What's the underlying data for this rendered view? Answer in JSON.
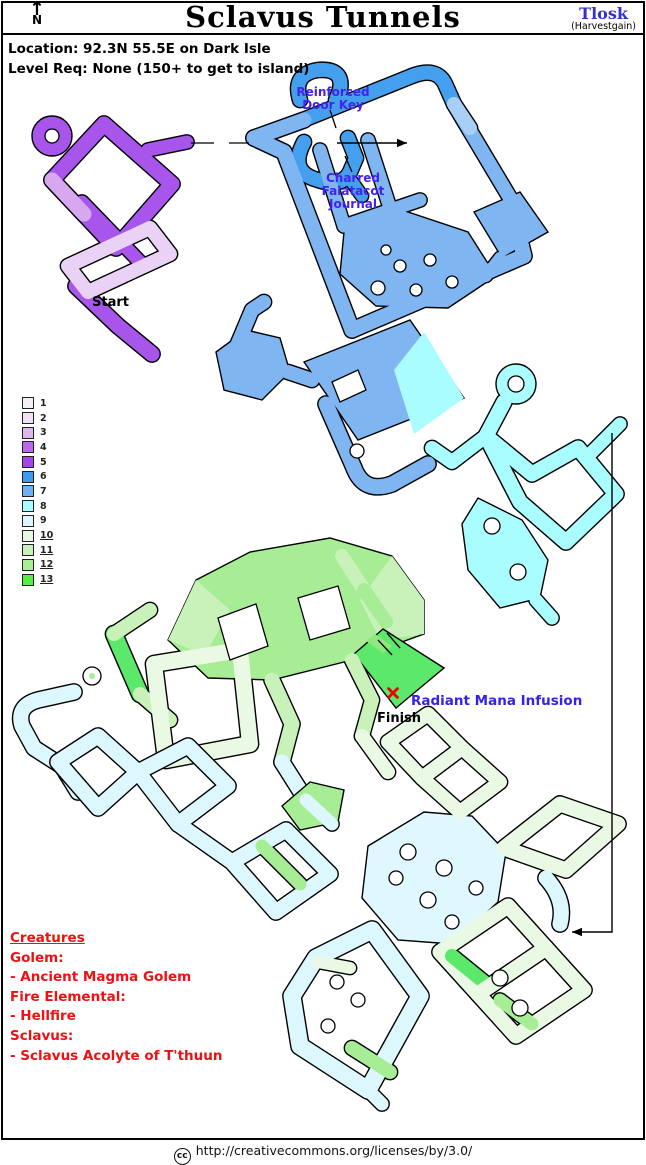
{
  "header": {
    "north_label": "N",
    "north_arrow": "↑",
    "title": "Sclavus Tunnels",
    "author": "Tlosk",
    "chapter": "(Harvestgain)"
  },
  "info": {
    "location": "Location: 92.3N 55.5E on Dark Isle",
    "level_req": "Level Req: None (150+ to get to island)"
  },
  "map_labels": {
    "door_key": "Reinforced\nDoor Key",
    "journal": "Charred\nFalatacot\nJournal",
    "start": "Start",
    "finish": "Finish",
    "radiant": "Radiant Mana Infusion"
  },
  "legend": {
    "items": [
      {
        "level": "1",
        "color": "#F8EEFA",
        "underlined": false
      },
      {
        "level": "2",
        "color": "#F2DFF4",
        "underlined": false
      },
      {
        "level": "3",
        "color": "#DCB8EE",
        "underlined": false
      },
      {
        "level": "4",
        "color": "#BB66EE",
        "underlined": false
      },
      {
        "level": "5",
        "color": "#A344ED",
        "underlined": false
      },
      {
        "level": "6",
        "color": "#3E9BEF",
        "underlined": false
      },
      {
        "level": "7",
        "color": "#6FB0F0",
        "underlined": false
      },
      {
        "level": "8",
        "color": "#A8FCFF",
        "underlined": false
      },
      {
        "level": "9",
        "color": "#DDF6FF",
        "underlined": false
      },
      {
        "level": "10",
        "color": "#E6F8DE",
        "underlined": true
      },
      {
        "level": "11",
        "color": "#C9F2BB",
        "underlined": true
      },
      {
        "level": "12",
        "color": "#A8EE99",
        "underlined": true
      },
      {
        "level": "13",
        "color": "#55EE44",
        "underlined": true
      }
    ]
  },
  "creatures": {
    "heading": "Creatures",
    "lines": [
      "Golem:",
      " - Ancient Magma Golem",
      "Fire Elemental:",
      " - Hellfire",
      "Sclavus:",
      " - Sclavus Acolyte of T'thuun"
    ]
  },
  "footer": {
    "cc_label": "cc",
    "license_url": "http://creativecommons.org/licenses/by/3.0/"
  },
  "colors": {
    "label_blue": "#4422EE",
    "creature_red": "#EE1111",
    "author_blue": "#3333CC",
    "marker_red": "#EE0000"
  },
  "map": {
    "sections": [
      {
        "name": "start-purple",
        "tubes": [
          {
            "d": "M 52,180 L 104,124 L 172,184 L 116,248 Z",
            "c": "#A855EC",
            "w": 15
          },
          {
            "d": "M 148,150 L 187,142",
            "c": "#A855EC",
            "w": 13
          },
          {
            "d": "M 82,202 L 140,262",
            "c": "#A855EC",
            "w": 13
          },
          {
            "d": "M 76,286 L 118,326 L 152,354",
            "c": "#A855EC",
            "w": 15
          },
          {
            "d": "M 52,180 L 84,214",
            "c": "#D7A8F0",
            "w": 15
          },
          {
            "d": "M 68,266 L 150,228 L 170,254 L 88,292 Z",
            "c": "#E9D2F5",
            "w": 14
          }
        ],
        "blobs": [
          {
            "cx": 52,
            "cy": 136,
            "r": 20,
            "c": "#A855EC"
          }
        ],
        "holes": [
          [
            52,
            136,
            7
          ]
        ]
      },
      {
        "name": "upper-blue",
        "tubes": [
          {
            "d": "M 300,100 Q 292,74 318,70 Q 344,68 340,90 L 336,100",
            "c": "#44A0EF",
            "w": 14
          },
          {
            "d": "M 298,122 L 412,76",
            "c": "#44A0EF",
            "w": 14
          },
          {
            "d": "M 412,76 Q 438,66 446,86 L 454,104",
            "c": "#44A0EF",
            "w": 14
          },
          {
            "d": "M 304,142 Q 288,172 318,180 Q 342,188 350,172 L 356,158 L 348,138",
            "c": "#44A0EF",
            "w": 14
          },
          {
            "d": "M 352,182 L 362,196",
            "c": "#44A0EF",
            "w": 12
          },
          {
            "d": "M 254,138 L 304,120",
            "c": "#7FB6F1",
            "w": 15
          },
          {
            "d": "M 254,138 L 284,152 L 352,330",
            "c": "#7FB6F1",
            "w": 15
          },
          {
            "d": "M 352,330 L 524,256 L 512,208",
            "c": "#7FB6F1",
            "w": 15
          },
          {
            "d": "M 454,104 L 516,208",
            "c": "#7FB6F1",
            "w": 14
          },
          {
            "d": "M 454,104 L 470,128",
            "c": "#AACFF7",
            "w": 14
          },
          {
            "d": "M 320,150 L 344,226",
            "c": "#7FB6F1",
            "w": 13
          },
          {
            "d": "M 368,140 L 392,214",
            "c": "#7FB6F1",
            "w": 13
          },
          {
            "d": "M 344,226 L 420,200",
            "c": "#7FB6F1",
            "w": 13
          },
          {
            "d": "M 500,258 L 486,276",
            "c": "#7FB6F1",
            "w": 12
          }
        ],
        "blobs": [
          {
            "pts": "474,212 520,192 548,232 502,258",
            "c": "#7FB6F1"
          },
          {
            "pts": "344,232 402,210 468,232 496,276 448,308 376,306 340,274",
            "c": "#7FB6F1"
          }
        ],
        "holes": [
          [
            378,
            288,
            7
          ],
          [
            400,
            266,
            6
          ],
          [
            430,
            260,
            6
          ],
          [
            452,
            282,
            6
          ],
          [
            416,
            290,
            6
          ],
          [
            386,
            250,
            5
          ]
        ]
      },
      {
        "name": "middle-blue-cyan",
        "tubes": [
          {
            "d": "M 236,348 L 252,310 L 264,302",
            "c": "#7FB6F1",
            "w": 14
          },
          {
            "d": "M 288,372 L 312,380",
            "c": "#7FB6F1",
            "w": 14
          },
          {
            "d": "M 326,404 L 354,468",
            "c": "#7FB6F1",
            "w": 15
          },
          {
            "d": "M 354,468 Q 364,494 392,484 L 428,464",
            "c": "#7FB6F1",
            "w": 15
          },
          {
            "d": "M 504,402 L 486,436",
            "c": "#A9FDFF",
            "w": 15
          },
          {
            "d": "M 486,436 L 532,474 L 578,448 L 616,494 L 566,542 L 520,502 Z",
            "c": "#A9FDFF",
            "w": 15
          },
          {
            "d": "M 592,452 L 620,424",
            "c": "#A9FDFF",
            "w": 13
          },
          {
            "d": "M 486,436 L 452,462 L 432,448",
            "c": "#A9FDFF",
            "w": 14
          },
          {
            "d": "M 536,600 L 552,618",
            "c": "#A9FDFF",
            "w": 13
          }
        ],
        "blobs": [
          {
            "pts": "216,352 246,330 280,338 290,372 262,400 224,390",
            "c": "#7FB6F1"
          },
          {
            "pts": "304,362 410,320 464,398 358,440",
            "c": "#7FB6F1"
          },
          {
            "pts": "424,332 464,398 414,434 394,370",
            "c": "#A9FDFF",
            "nostroke": true
          },
          {
            "cx": 516,
            "cy": 384,
            "r": 20,
            "c": "#A9FDFF"
          },
          {
            "pts": "478,498 522,520 548,560 540,598 500,608 468,570 462,524",
            "c": "#A9FDFF"
          }
        ],
        "holes": [
          [
            516,
            384,
            8
          ],
          [
            357,
            451,
            7
          ],
          [
            492,
            526,
            8
          ],
          [
            518,
            572,
            8
          ]
        ],
        "holePolys": [
          "332,382 358,370 366,390 340,402"
        ]
      },
      {
        "name": "green-top",
        "tubes": [
          {
            "d": "M 114,634 L 140,694",
            "c": "#5CE86A",
            "w": 16
          },
          {
            "d": "M 114,634 L 150,610",
            "c": "#C9F2BB",
            "w": 14
          },
          {
            "d": "M 140,694 L 170,720",
            "c": "#C9F2BB",
            "w": 14
          },
          {
            "d": "M 154,664 L 240,650 L 250,744 L 166,760 Z",
            "c": "#E9F9E4",
            "w": 16
          },
          {
            "d": "M 342,556 L 364,590",
            "c": "#C9F2BB",
            "w": 14
          },
          {
            "d": "M 364,590 L 386,622",
            "c": "#A6ED96",
            "w": 14
          },
          {
            "d": "M 272,680 L 292,724 L 282,762",
            "c": "#C9F2BB",
            "w": 15
          },
          {
            "d": "M 282,762 L 306,800",
            "c": "#DCF7FE",
            "w": 15
          },
          {
            "d": "M 352,660 L 372,700 L 362,736",
            "c": "#C9F2BB",
            "w": 14
          },
          {
            "d": "M 362,736 L 388,772",
            "c": "#E9F9E4",
            "w": 14
          },
          {
            "d": "M 74,692 L 38,700 Q 16,706 22,726 L 34,748 L 62,766 L 78,792",
            "c": "#DCF7FE",
            "w": 15
          }
        ],
        "blobs": [
          {
            "pts": "168,640 196,580 250,552 330,538 392,556 424,600 424,634 352,660 272,680 208,678",
            "c": "#A6ED96"
          },
          {
            "pts": "168,640 196,580 230,610 205,655",
            "c": "#C9F2BB",
            "nostroke": true
          },
          {
            "pts": "392,556 424,600 424,634 380,640 360,600",
            "c": "#C9F2BB",
            "nostroke": true
          },
          {
            "pts": "383,629 444,668 396,708 354,654",
            "c": "#5CE86A"
          },
          {
            "pts": "375,634 392,646 383,653 366,641",
            "c": "#8FE87E",
            "nostroke": true
          }
        ],
        "holes": [
          [
            92,
            676,
            9
          ]
        ],
        "holePolys": [
          "218,618 256,604 268,646 230,660",
          "298,598 338,586 350,628 310,640"
        ],
        "dots": [
          [
            92,
            676,
            3,
            "#A6ED96"
          ]
        ],
        "marks": [
          "M 378,640 L 392,655",
          "M 387,633 L 400,648"
        ]
      },
      {
        "name": "bottom-maze",
        "tubes": [
          {
            "d": "M 58,762 L 98,736 L 138,772 L 98,808 Z",
            "c": "#DCF7FE",
            "w": 15
          },
          {
            "d": "M 138,772 L 188,746 L 228,786 L 178,824 Z",
            "c": "#DCF7FE",
            "w": 15
          },
          {
            "d": "M 178,824 L 232,862",
            "c": "#DCF7FE",
            "w": 15
          },
          {
            "d": "M 232,862 L 286,830 L 330,874 L 276,912 Z",
            "c": "#DCF7FE",
            "w": 15
          },
          {
            "d": "M 262,846 L 300,884",
            "c": "#A6ED96",
            "w": 13
          },
          {
            "d": "M 388,742 L 428,714 L 462,748 L 422,778 Z",
            "c": "#E9F9E4",
            "w": 14
          },
          {
            "d": "M 422,778 L 462,748 L 500,782 L 460,812 Z",
            "c": "#E9F9E4",
            "w": 14
          },
          {
            "d": "M 504,848 L 560,804 L 618,824 L 566,870 Z",
            "c": "#E9F9E4",
            "w": 15
          },
          {
            "d": "M 546,878 Q 566,900 560,924",
            "c": "#DCF7FE",
            "w": 15
          },
          {
            "d": "M 440,952 L 508,906 L 546,948 L 478,994 Z",
            "c": "#E9F9E4",
            "w": 15
          },
          {
            "d": "M 452,956 L 484,982",
            "c": "#5CE86A",
            "w": 14
          },
          {
            "d": "M 478,994 L 546,948 L 584,990 L 516,1036 Z",
            "c": "#E9F9E4",
            "w": 15
          },
          {
            "d": "M 500,1000 L 532,1024",
            "c": "#A6ED96",
            "w": 13
          },
          {
            "d": "M 316,958 L 372,930 L 420,996 L 368,1090 L 300,1046 L 292,996 Z",
            "c": "#DCF7FE",
            "w": 17
          },
          {
            "d": "M 352,1048 L 390,1072",
            "c": "#A6ED96",
            "w": 14
          },
          {
            "d": "M 318,962 L 350,968",
            "c": "#E9F9E4",
            "w": 12
          },
          {
            "d": "M 368,1090 L 382,1104",
            "c": "#DCF7FE",
            "w": 13
          },
          {
            "d": "M 306,800 L 332,824",
            "c": "#DCF7FE",
            "w": 13
          }
        ],
        "blobs": [
          {
            "pts": "368,846 424,812 472,816 506,852 498,902 452,944 398,940 362,898",
            "c": "#DFF8FF"
          },
          {
            "pts": "282,806 310,782 344,790 338,822 300,830",
            "c": "#A6ED96"
          }
        ],
        "holes": [
          [
            408,
            852,
            8
          ],
          [
            444,
            868,
            8
          ],
          [
            476,
            888,
            7
          ],
          [
            428,
            900,
            8
          ],
          [
            396,
            878,
            7
          ],
          [
            452,
            922,
            7
          ],
          [
            500,
            978,
            8
          ],
          [
            337,
            982,
            7
          ],
          [
            358,
            1000,
            7
          ],
          [
            328,
            1026,
            7
          ],
          [
            520,
            1008,
            8
          ]
        ]
      }
    ],
    "decorations": {
      "dashes": [
        [
          191,
          143,
          214,
          143
        ],
        [
          229,
          143,
          249,
          143
        ]
      ],
      "leaders": [
        [
          330,
          110,
          336,
          128
        ],
        [
          352,
          172,
          345,
          156
        ]
      ],
      "arrows": [
        {
          "points": [
            [
              337,
              143
            ],
            [
              407,
              143
            ]
          ]
        },
        {
          "points": [
            [
              612,
              433
            ],
            [
              612,
              932
            ],
            [
              572,
              932
            ]
          ]
        }
      ],
      "xmark": {
        "x": 393,
        "y": 693
      }
    }
  }
}
